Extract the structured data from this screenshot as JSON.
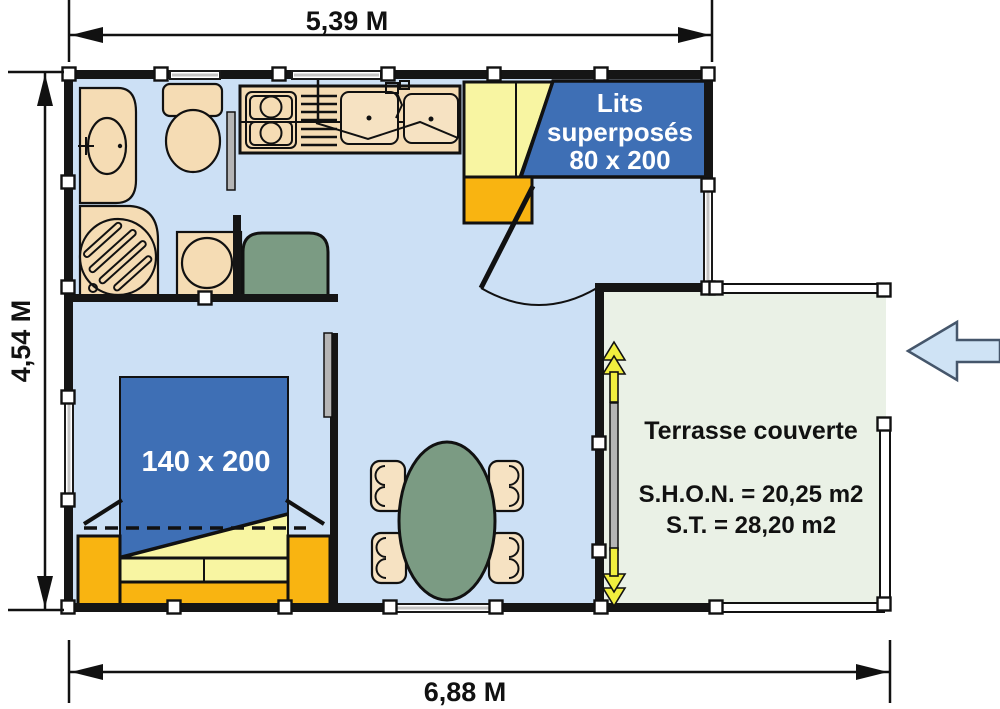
{
  "dimensions": {
    "width_top": "5,39 M",
    "height_left": "4,54 M",
    "width_bottom": "6,88 M"
  },
  "rooms": {
    "bunk_beds": {
      "line1": "Lits",
      "line2": "superposés",
      "line3": "80 x 200"
    },
    "bedroom_bed_label": "140 x 200",
    "terrace": {
      "title": "Terrasse couverte",
      "area_shon": "S.H.O.N. = 20,25 m2",
      "area_st": "S.T. = 28,20 m2"
    }
  },
  "colors": {
    "floor_blue": "#cce0f5",
    "terrace_green": "#eaf1e6",
    "wall_black": "#151515",
    "furniture_cream": "#f5dcb4",
    "sink_cream": "#f6e2c2",
    "accent_blue": "#3e6fb5",
    "accent_orange": "#f9b411",
    "pale_yellow": "#f8f5a2",
    "sage_green": "#7b9b83",
    "window_gray": "#c4c4c4",
    "door_gray": "#b5b5b5",
    "arrow_yellow": "#f1ee3e",
    "entry_arrow_fill": "#cfe3f5",
    "entry_arrow_border": "#45566b",
    "label_white": "#ffffff",
    "label_black": "#111111"
  }
}
